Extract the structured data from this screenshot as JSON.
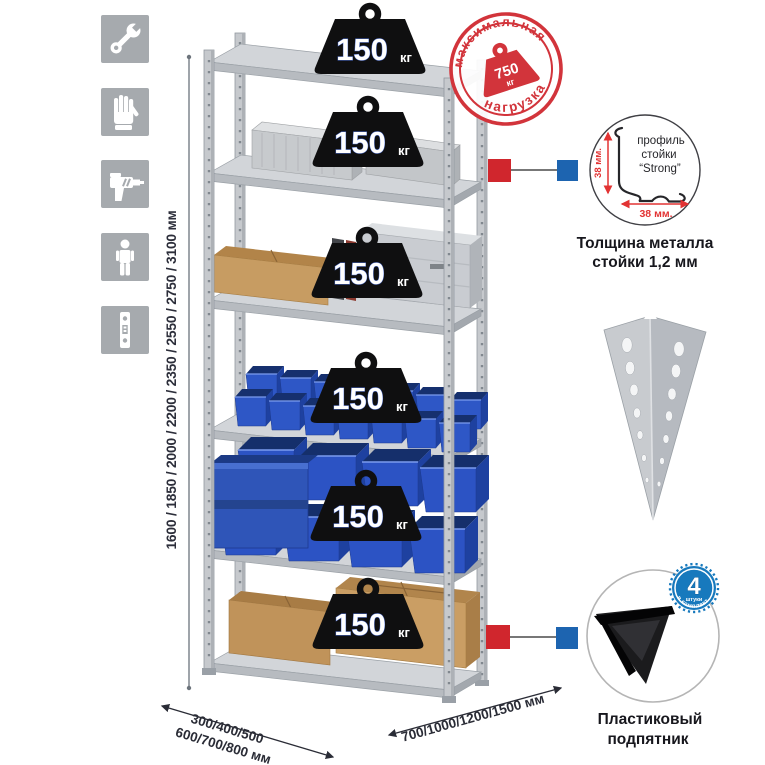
{
  "canvas": {
    "background": "#ffffff"
  },
  "colors": {
    "accent_red": "#d0262d",
    "accent_blue": "#1d64b0",
    "stamp_red": "#d2343b",
    "bin_blue": "#2c53c4",
    "badge_blue": "#1779bd",
    "metal_gray": "#c6c9cd",
    "tile_gray": "#a6aaae",
    "cardboard_tan": "#c79c62"
  },
  "left_panel": {
    "icons": [
      {
        "name": "wrench-icon"
      },
      {
        "name": "work-gloves-icon"
      },
      {
        "name": "drill-icon"
      },
      {
        "name": "person-icon"
      },
      {
        "name": "perforated-post-icon"
      }
    ]
  },
  "dimensions": {
    "height_label": "1600 / 1850 / 2000 / 2200 / 2350 / 2550 / 2750 / 3100 мм",
    "width_label": "700/1000/1200/1500 мм",
    "depth_label_line1": "300/400/500",
    "depth_label_line2": "600/700/800 мм"
  },
  "max_load_stamp": {
    "arc_top": "максимальная",
    "arc_bottom": "нагрузка",
    "value": "750",
    "unit": "кг"
  },
  "shelf_loads": [
    {
      "value": "150",
      "unit": "кг"
    },
    {
      "value": "150",
      "unit": "кг"
    },
    {
      "value": "150",
      "unit": "кг"
    },
    {
      "value": "150",
      "unit": "кг"
    },
    {
      "value": "150",
      "unit": "кг"
    },
    {
      "value": "150",
      "unit": "кг"
    }
  ],
  "post_profile_detail": {
    "label_line1": "профиль",
    "label_line2": "стойки",
    "label_line3": "“Strong”",
    "vertical_dim": "38 мм.",
    "horizontal_dim": "38 мм.",
    "caption_line1": "Толщина металла",
    "caption_line2": "стойки 1,2 мм"
  },
  "foot_detail": {
    "badge_count": "4",
    "badge_small_text": "штуки",
    "badge_arc_text": "в комплекте",
    "caption_line1": "Пластиковый",
    "caption_line2": "подпятник"
  }
}
